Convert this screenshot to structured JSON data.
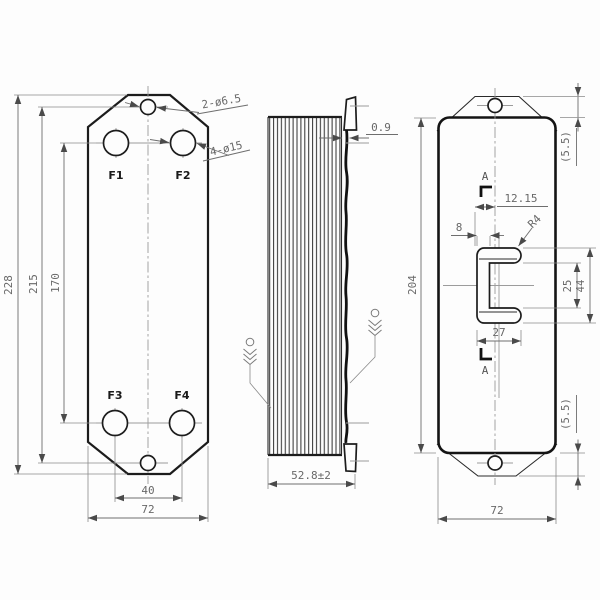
{
  "title": "Plate heat exchanger engineering drawing, three orthographic views",
  "colors": {
    "background": "#fdfdfd",
    "outline": "#1c1c1c",
    "dimension": "#686868",
    "centerline": "#9c9c9c"
  },
  "views": {
    "front": {
      "ports": {
        "f1": "F1",
        "f2": "F2",
        "f3": "F3",
        "f4": "F4"
      },
      "callouts": {
        "mount_holes": "2-ø6.5",
        "ports": "4-ø15"
      },
      "dims": {
        "overall_height": "228",
        "mount_hole_pitch": "215",
        "port_pitch_v": "170",
        "port_pitch_h": "40",
        "width": "72"
      }
    },
    "side": {
      "dims": {
        "plate_thickness": "0.9",
        "depth": "52.8±2"
      }
    },
    "back": {
      "dims": {
        "height": "204",
        "width": "72",
        "boss_offset": "12.15",
        "web_width": "8",
        "boss_width": "27",
        "inner_height": "25",
        "outer_height": "44",
        "fillet_radius": "R4",
        "tab_top": "(5.5)",
        "tab_bottom": "(5.5)"
      },
      "section": {
        "top": "A",
        "bottom": "A"
      }
    }
  }
}
